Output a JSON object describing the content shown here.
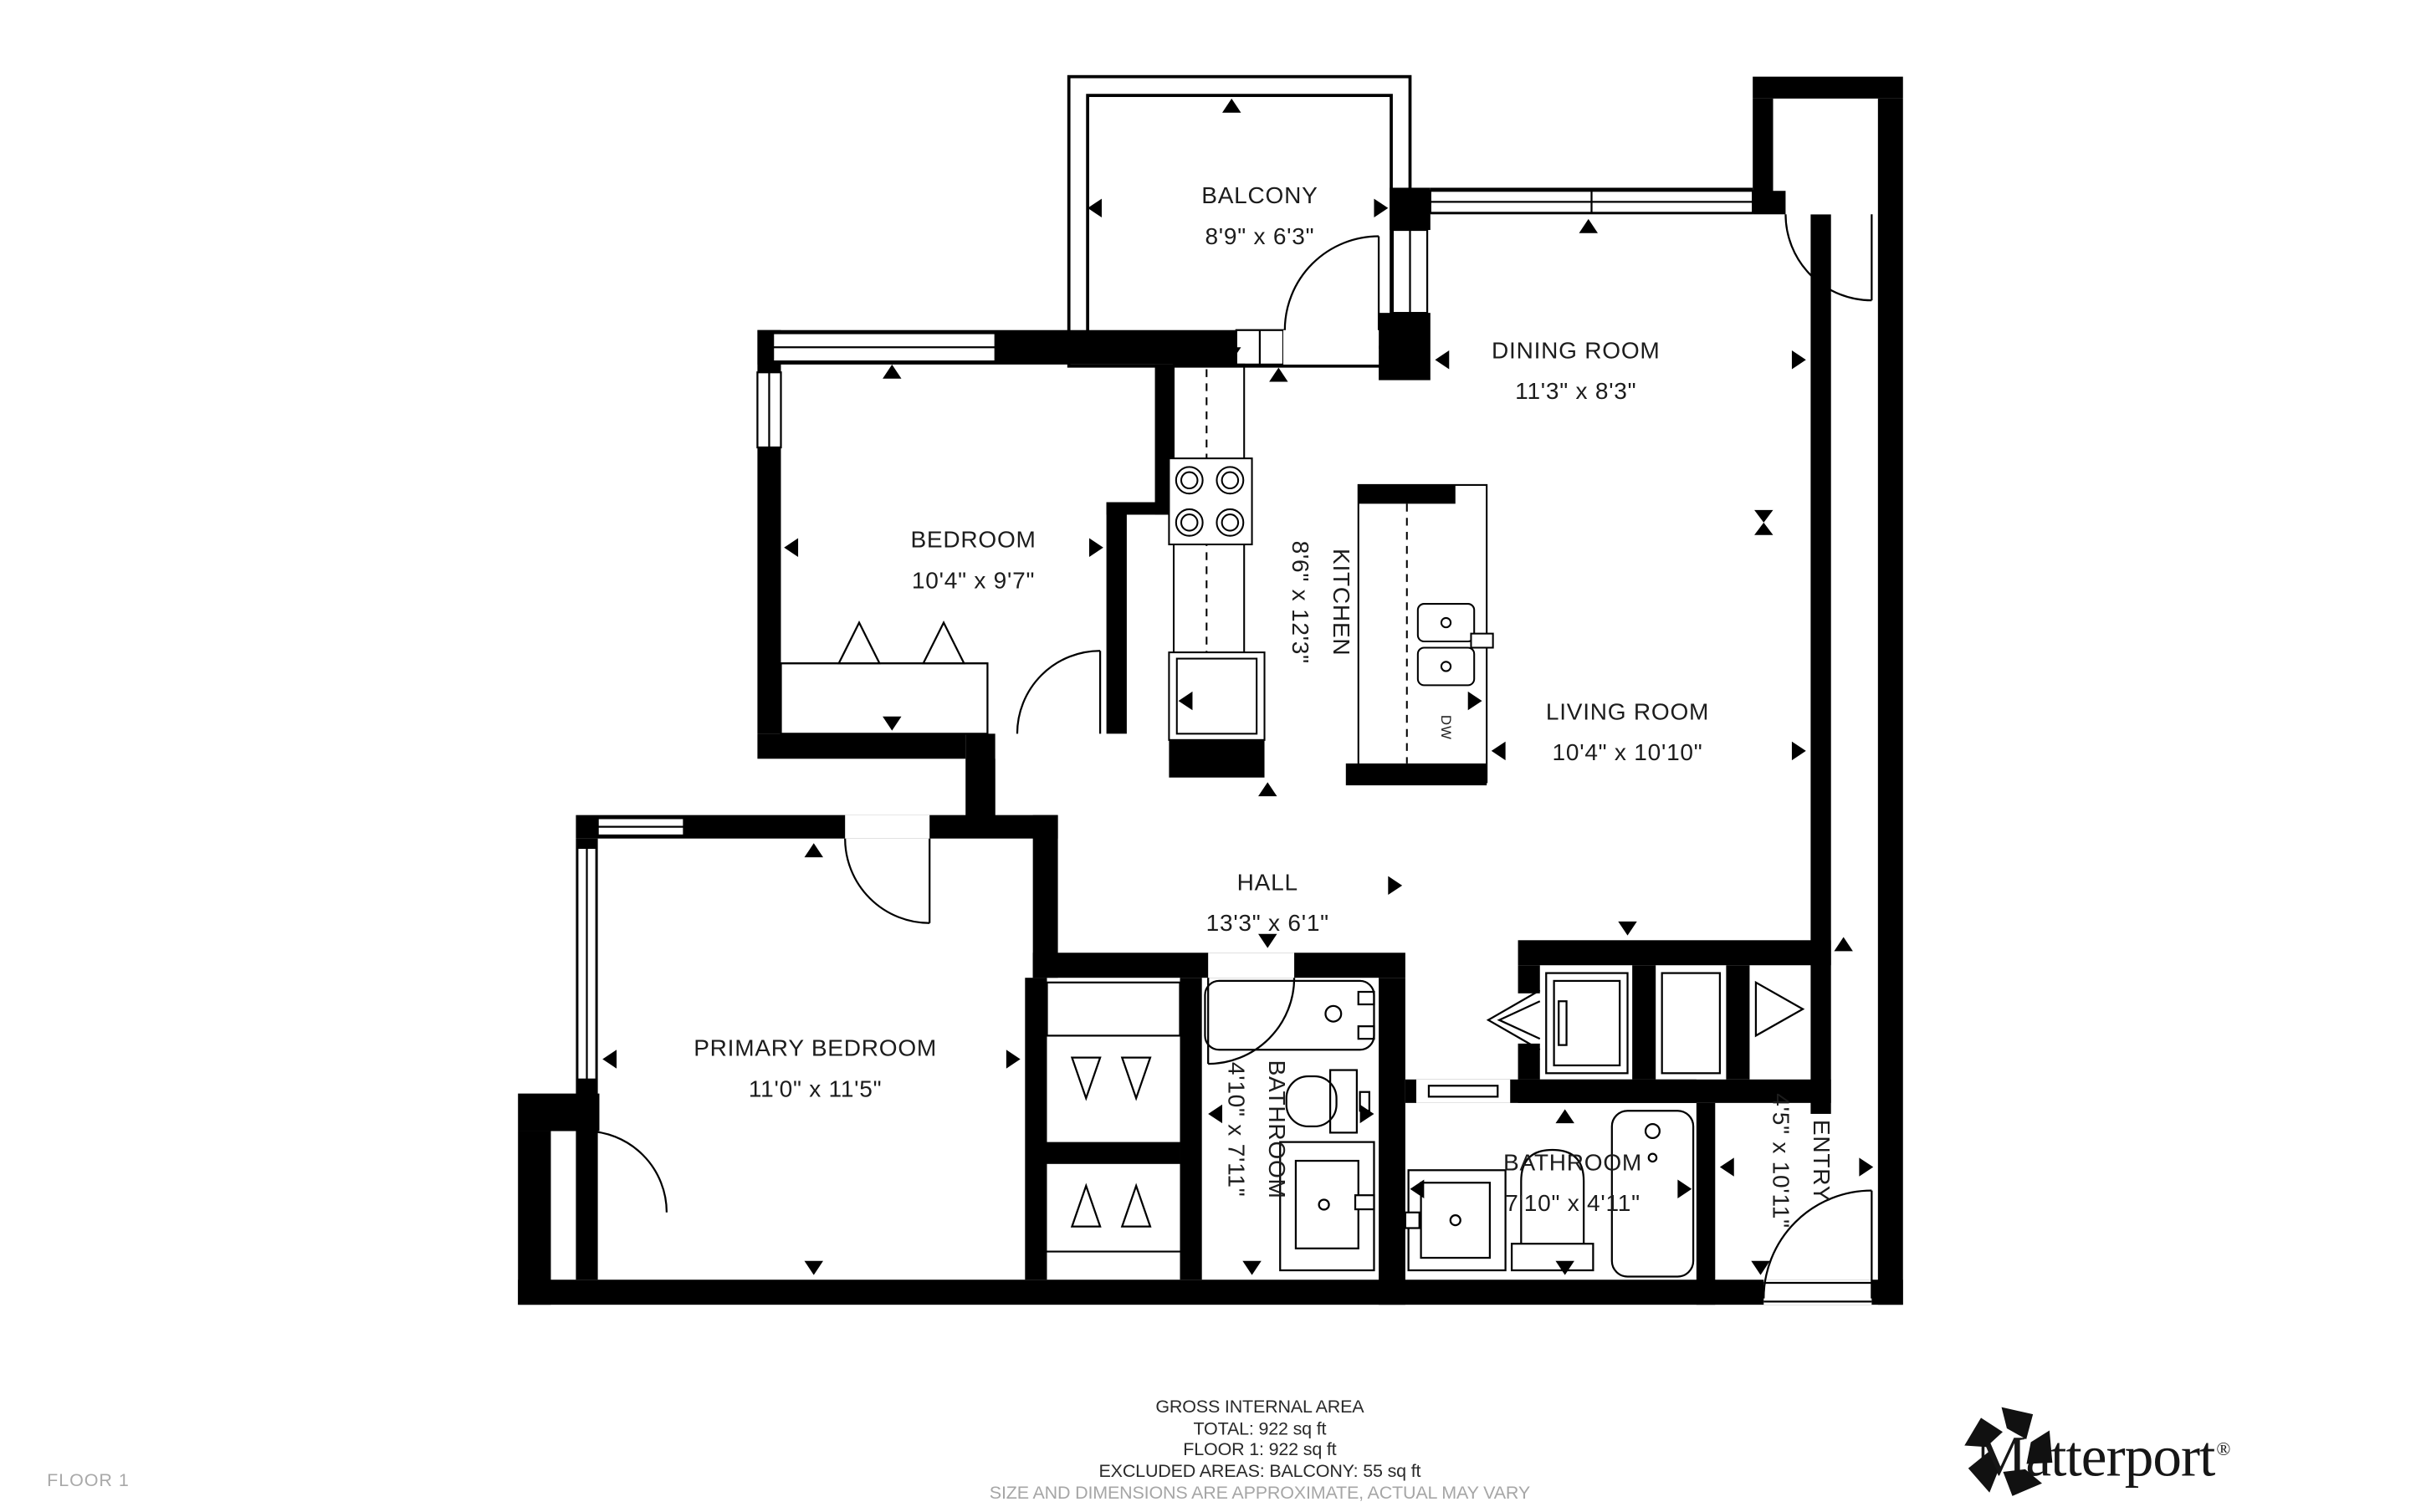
{
  "rooms": {
    "balcony": {
      "name": "BALCONY",
      "dims": "8'9\" x 6'3\""
    },
    "dining_room": {
      "name": "DINING ROOM",
      "dims": "11'3\" x 8'3\""
    },
    "bedroom": {
      "name": "BEDROOM",
      "dims": "10'4\" x 9'7\""
    },
    "kitchen": {
      "name": "KITCHEN",
      "dims": "8'6\" x 12'3\""
    },
    "living_room": {
      "name": "LIVING ROOM",
      "dims": "10'4\" x 10'10\""
    },
    "hall": {
      "name": "HALL",
      "dims": "13'3\" x 6'1\""
    },
    "primary_bedroom": {
      "name": "PRIMARY BEDROOM",
      "dims": "11'0\" x 11'5\""
    },
    "bathroom_small": {
      "name": "BATHROOM",
      "dims": "4'10\" x 7'11\""
    },
    "bathroom_main": {
      "name": "BATHROOM",
      "dims": "7'10\" x 4'11\""
    },
    "entry": {
      "name": "ENTRY",
      "dims": "4'5\" x 10'11\""
    }
  },
  "appliances": {
    "dishwasher_label": "DW"
  },
  "footer": {
    "line1": "GROSS INTERNAL AREA",
    "line2": "TOTAL: 922 sq ft",
    "line3": "FLOOR 1: 922 sq ft",
    "line4": "EXCLUDED AREAS: BALCONY: 55 sq ft",
    "disclaimer": "SIZE AND DIMENSIONS ARE APPROXIMATE, ACTUAL MAY VARY"
  },
  "floor_label": "FLOOR 1",
  "brand": {
    "wordmark": "Matterport",
    "registered_mark": "®"
  },
  "colors": {
    "walls": "#000000",
    "text": "#1c1c1c",
    "muted": "#a6a6a6",
    "background": "#ffffff"
  }
}
